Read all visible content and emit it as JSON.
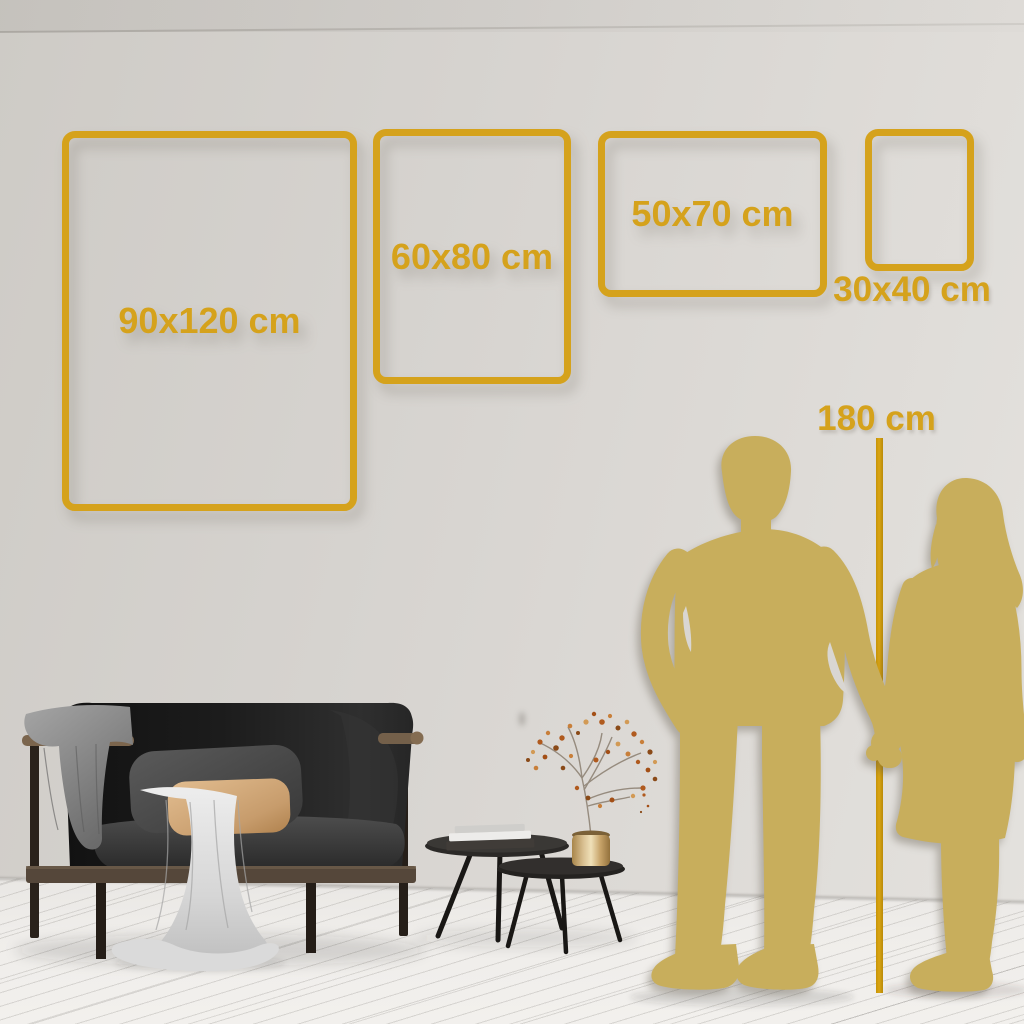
{
  "title": "Wall art poster size comparison guide",
  "colors": {
    "accent_gold": "#d5a21c",
    "silhouette_gold": "#c8ae5c",
    "wall": "#d7d4d0",
    "floor": "#efedea"
  },
  "size_guide": {
    "unit": "cm",
    "frames": [
      {
        "label": "90x120 cm",
        "width_cm": 90,
        "height_cm": 120
      },
      {
        "label": "60x80 cm",
        "width_cm": 60,
        "height_cm": 80
      },
      {
        "label": "50x70 cm",
        "width_cm": 50,
        "height_cm": 70
      },
      {
        "label": "30x40 cm",
        "width_cm": 30,
        "height_cm": 40
      }
    ],
    "height_reference": {
      "label": "180 cm",
      "height_cm": 180
    }
  },
  "scene": {
    "illustrations": [
      "dark-sofa-with-blanket-and-pillows",
      "white-drape-cloth",
      "nesting-coffee-tables-with-books",
      "brass-vase-with-dried-branch",
      "man-silhouette",
      "woman-silhouette",
      "couple-holding-hands"
    ]
  }
}
